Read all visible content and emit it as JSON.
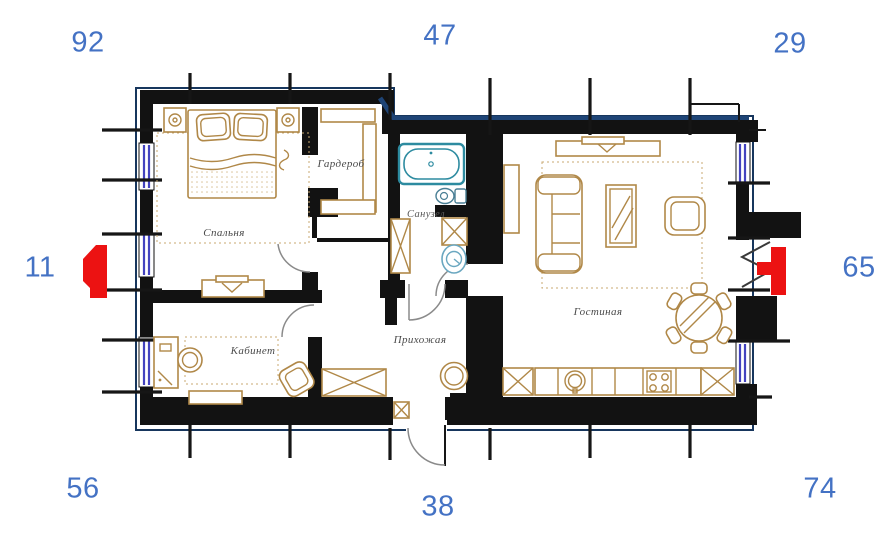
{
  "figure": {
    "type": "apartment floor plan",
    "language": "ru"
  },
  "palette": {
    "number_blue": "#4472c4",
    "wall_black": "#121212",
    "outline_navy": "#1e4476",
    "window_violet": "#4343bf",
    "furniture_tan": "#b08848",
    "sanitary_teal": "#2d8ba0",
    "marker_red": "#ec1212"
  },
  "numbers": {
    "top_left": "92",
    "top_center": "47",
    "top_right": "29",
    "left": "11",
    "right": "65",
    "bottom_left": "56",
    "bottom_center": "38",
    "bottom_right": "74"
  },
  "rooms": {
    "bedroom": {
      "label": "Спальня"
    },
    "wardrobe": {
      "label": "Гардероб"
    },
    "bathroom": {
      "label": "Санузел"
    },
    "study": {
      "label": "Кабинет"
    },
    "hallway": {
      "label": "Прихожая"
    },
    "living_room": {
      "label": "Гостиная"
    }
  }
}
